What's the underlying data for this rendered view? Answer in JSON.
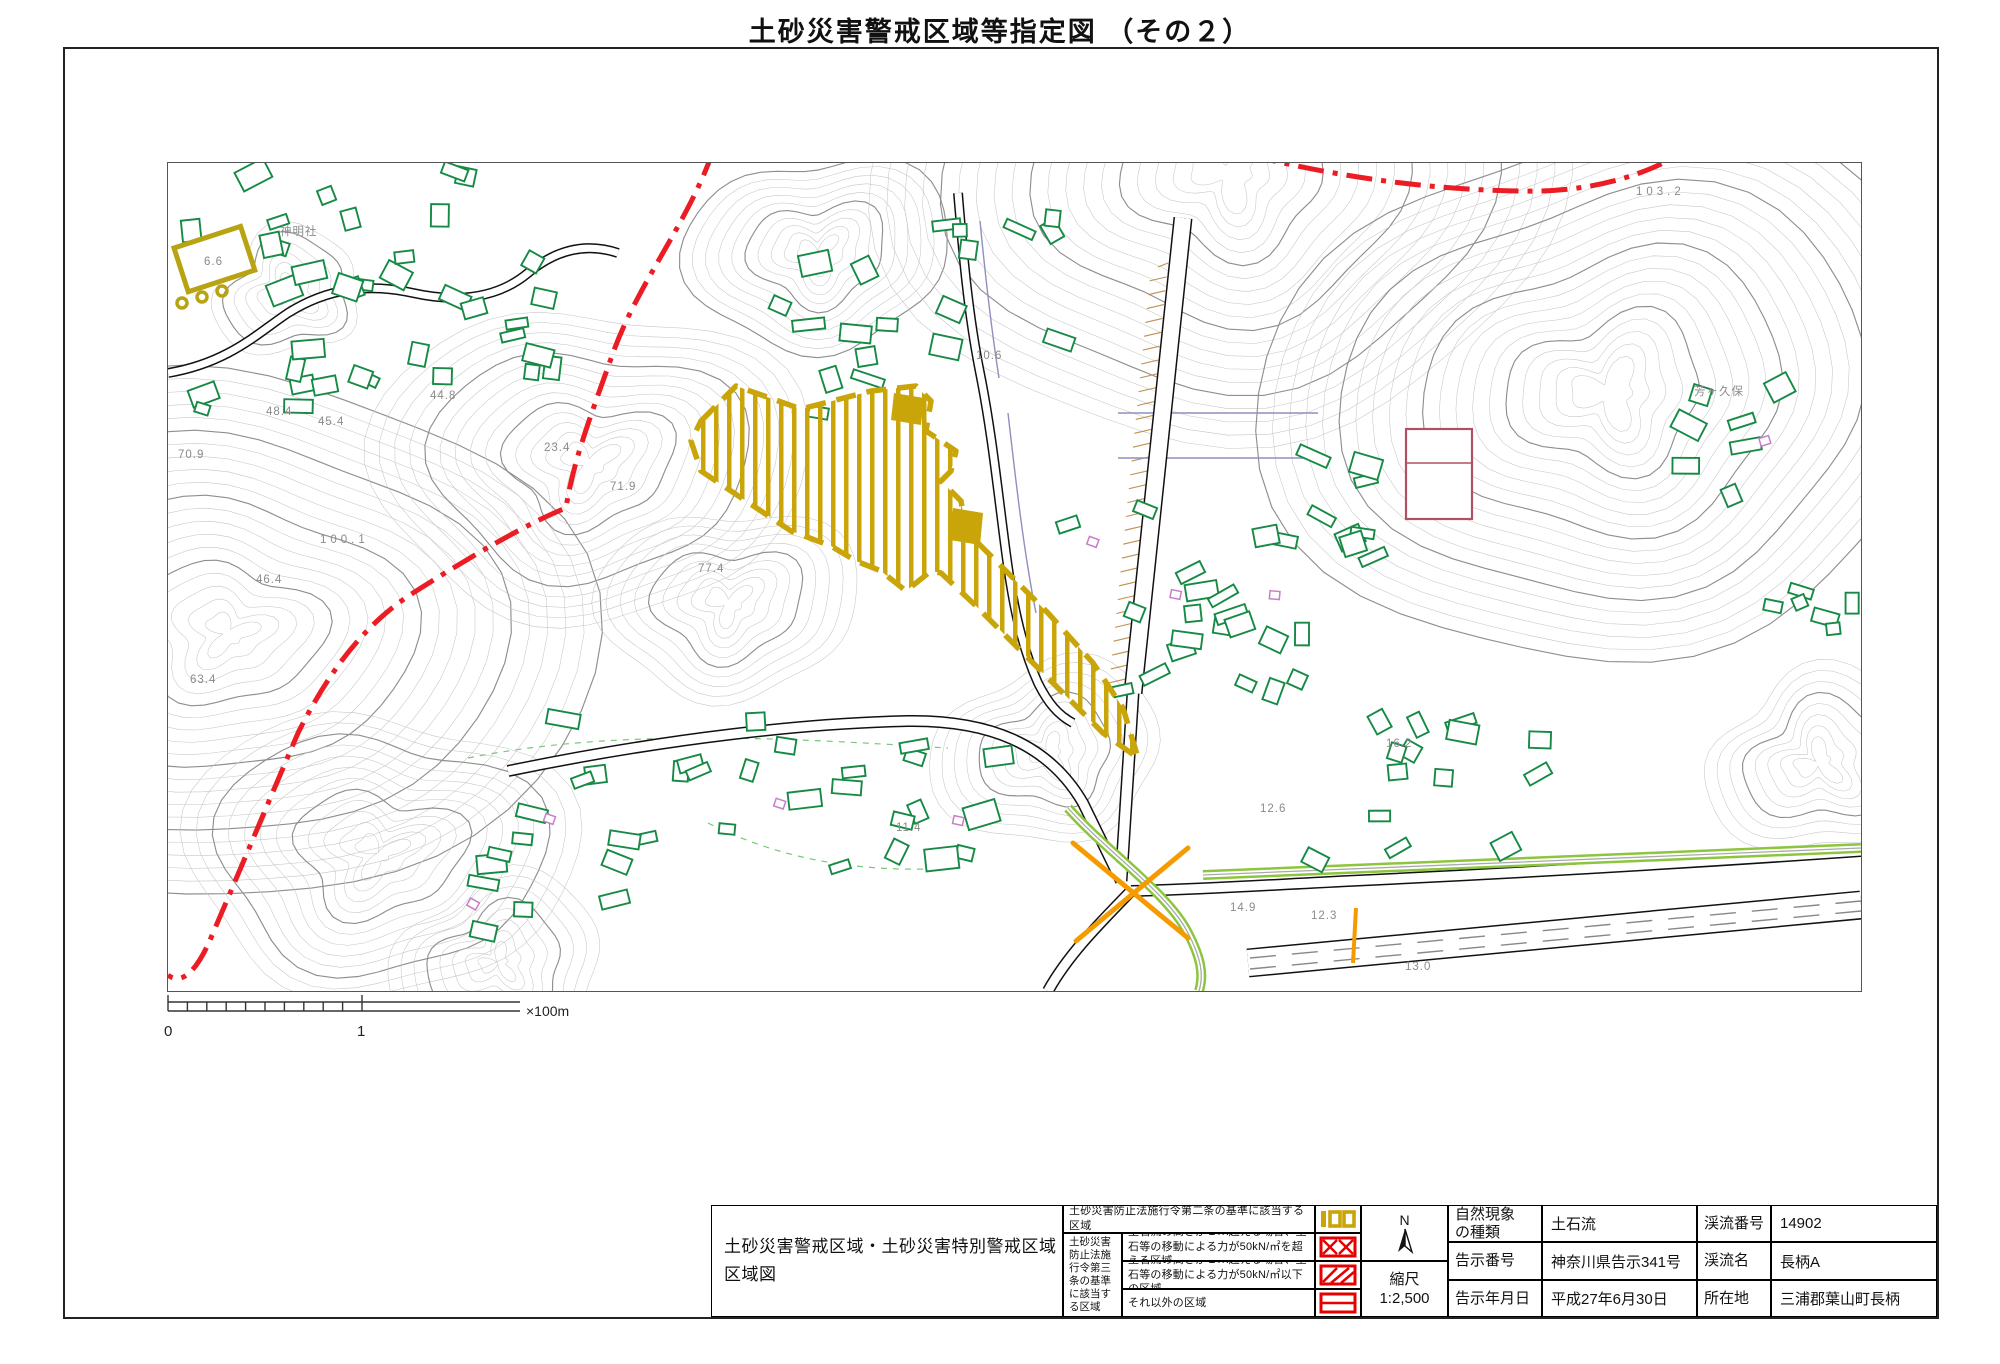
{
  "title": "土砂災害警戒区域等指定図 （その２）",
  "scalebar": {
    "zero": "0",
    "one": "1",
    "unit": "×100m"
  },
  "north_label": "N",
  "scale_box": {
    "label": "縮尺",
    "value": "1:2,500"
  },
  "legend": {
    "map_title_line1": "土砂災害警戒区域・土砂災害特別警戒区域",
    "map_title_line2": "区域図",
    "article2_zone": "土砂災害防止法施行令第二条の基準に該当する区域",
    "article3_zone": "土砂災害防止法施行令第三条の基準に該当する区域",
    "row_over50": "土石流の高さが１ｍ超える場合、土石等の移動による力が50kN/㎡を超える区域",
    "row_under50": "土石流の高さが１ｍ超える場合、土石等の移動による力が50kN/㎡以下の区域",
    "row_other": "それ以外の区域",
    "swatches": [
      "warning-zone-yellow-hatch",
      "special-zone-crosshatch",
      "special-zone-diagonal-hatch",
      "special-zone-horizontal-line"
    ]
  },
  "info": {
    "left_rows": [
      {
        "label": "自然現象\nの種類",
        "value": "土石流"
      },
      {
        "label": "告示番号",
        "value": "神奈川県告示341号"
      },
      {
        "label": "告示年月日",
        "value": "平成27年6月30日"
      }
    ],
    "right_rows": [
      {
        "label": "渓流番号",
        "value": "14902"
      },
      {
        "label": "渓流名",
        "value": "長柄A"
      },
      {
        "label": "所在地",
        "value": "三浦郡葉山町長柄"
      }
    ]
  },
  "map": {
    "labels": [
      {
        "t": "103.2",
        "x": 1468,
        "y": 32
      },
      {
        "t": "芳ヶ久保",
        "x": 1526,
        "y": 232
      },
      {
        "t": "神明社",
        "x": 112,
        "y": 72
      },
      {
        "t": "6.6",
        "x": 36,
        "y": 102
      },
      {
        "t": "48.4",
        "x": 98,
        "y": 252
      },
      {
        "t": "45.4",
        "x": 150,
        "y": 262
      },
      {
        "t": "44.8",
        "x": 262,
        "y": 236
      },
      {
        "t": "70.9",
        "x": 10,
        "y": 295
      },
      {
        "t": "100.1",
        "x": 152,
        "y": 380
      },
      {
        "t": "46.4",
        "x": 88,
        "y": 420
      },
      {
        "t": "63.4",
        "x": 22,
        "y": 520
      },
      {
        "t": "23.4",
        "x": 376,
        "y": 288
      },
      {
        "t": "71.9",
        "x": 442,
        "y": 327
      },
      {
        "t": "77.4",
        "x": 530,
        "y": 409
      },
      {
        "t": "10.6",
        "x": 808,
        "y": 196
      },
      {
        "t": "11.4",
        "x": 728,
        "y": 668
      },
      {
        "t": "12.6",
        "x": 1092,
        "y": 649
      },
      {
        "t": "14.9",
        "x": 1062,
        "y": 748
      },
      {
        "t": "12.3",
        "x": 1143,
        "y": 756
      },
      {
        "t": "13.0",
        "x": 1237,
        "y": 807
      },
      {
        "t": "16.2",
        "x": 1218,
        "y": 584
      }
    ],
    "colors": {
      "contour": "#c6c6c6",
      "contour_index": "#8f8f8f",
      "building": "#168a45",
      "warning_zone": "#c9a50a",
      "special_red": "#e60000",
      "boundary_red": "#ec1c24",
      "road_orange": "#f59b00",
      "river_green": "#8cc63e",
      "slope_tan": "#c09050",
      "parcel_purple": "#8f8fc0"
    }
  }
}
